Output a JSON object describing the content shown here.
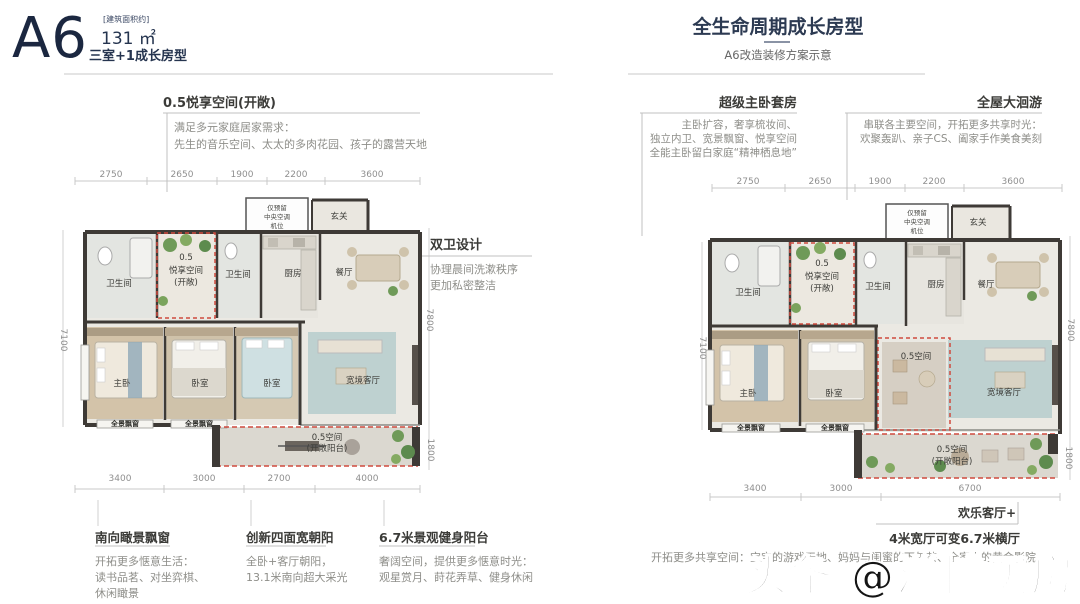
{
  "header": {
    "plan_code": "A6",
    "area_bracket": "[建筑面积约]",
    "area_value": "131 ㎡",
    "plan_type": "三室+1成长房型",
    "right_title": "全生命周期成长房型",
    "right_subtitle": "A6改造装修方案示意"
  },
  "colors": {
    "accent_red_dashed": "#cf4a3e",
    "wall_dark": "#3e3a36",
    "title_navy": "#1b2740",
    "dim_gray": "#8f8f8f",
    "plant_green": "#6f9a58"
  },
  "callouts": {
    "left_top": {
      "title": "0.5悦享空间(开敞)",
      "line1": "满足多元家庭居家需求：",
      "line2": "先生的音乐空间、太太的多肉花园、孩子的露营天地"
    },
    "dual_bath": {
      "title": "双卫设计",
      "line1": "协理晨间洗漱秩序",
      "line2": "更加私密整洁"
    },
    "master_suite": {
      "title": "超级主卧套房",
      "line1": "主卧扩容，奢享梳妆间、",
      "line2": "独立内卫、宽景飘窗、悦享空间",
      "line3": "全能主卧留白家庭“精神栖息地”"
    },
    "loop": {
      "title": "全屋大洄游",
      "line1": "串联各主要空间，开拓更多共享时光：",
      "line2": "欢聚轰趴、亲子CS、阖家手作美食美刻"
    },
    "south_window": {
      "title": "南向瞰景飘窗",
      "line1": "开拓更多惬意生活：",
      "line2": "读书品茗、对坐弈棋、",
      "line3": "休闲瞰景"
    },
    "four_bays": {
      "title": "创新四面宽朝阳",
      "line1": "全卧+客厅朝阳，",
      "line2": "13.1米南向超大采光"
    },
    "fit_balcony": {
      "title": "6.7米景观健身阳台",
      "line1": "奢阔空间，提供更多惬意时光：",
      "line2": "观星赏月、莳花弄草、健身休闲"
    },
    "happy_living": {
      "title": "欢乐客厅+",
      "subtitle": "4米宽厅可变6.7米横厅",
      "line1": "开拓更多共享空间：宝宝的游戏天地、妈妈与闺蜜的下午茶、全家人的黄金影院"
    }
  },
  "left_plan": {
    "dims_top": [
      "2750",
      "2650",
      "1900",
      "2200",
      "3600"
    ],
    "dims_bottom": [
      "3400",
      "3000",
      "2700",
      "4000"
    ],
    "dim_left": "7100",
    "dim_right_upper": "7800",
    "dim_right_lower": "1800",
    "rooms": {
      "ac1": "仅预留",
      "ac2": "中央空调",
      "ac3": "机位",
      "entry": "玄关",
      "bath1": "卫生间",
      "bath2": "卫生间",
      "flex1": "0.5",
      "flex2": "悦享空间",
      "flex3": "(开敞)",
      "kitchen": "厨房",
      "dining": "餐厅",
      "master": "主卧",
      "bed2": "卧室",
      "bed3": "卧室",
      "living": "宽境客厅",
      "bay1": "全景飘窗",
      "bay2": "全景飘窗",
      "balc1": "0.5空间",
      "balc2": "(开敞阳台)"
    }
  },
  "right_plan": {
    "dims_top": [
      "2750",
      "2650",
      "1900",
      "2200",
      "3600"
    ],
    "dims_bottom": [
      "3400",
      "3000",
      "6700"
    ],
    "dim_left": "7100",
    "dim_right_upper": "7800",
    "dim_right_lower": "1800",
    "rooms": {
      "ac1": "仅预留",
      "ac2": "中央空调",
      "ac3": "机位",
      "entry": "玄关",
      "bath1": "卫生间",
      "bath2": "卫生间",
      "flex1": "0.5",
      "flex2": "悦享空间",
      "flex3": "(开敞)",
      "kitchen": "厨房",
      "dining": "餐厅",
      "master": "主卧",
      "bed2": "卧室",
      "living": "宽境客厅",
      "flex_living": "0.5空间",
      "bay1": "全景飘窗",
      "bay2": "全景飘窗",
      "balc1": "0.5空间",
      "balc2": "(开敞阳台)"
    }
  },
  "watermark": "头条 @淄博买房"
}
